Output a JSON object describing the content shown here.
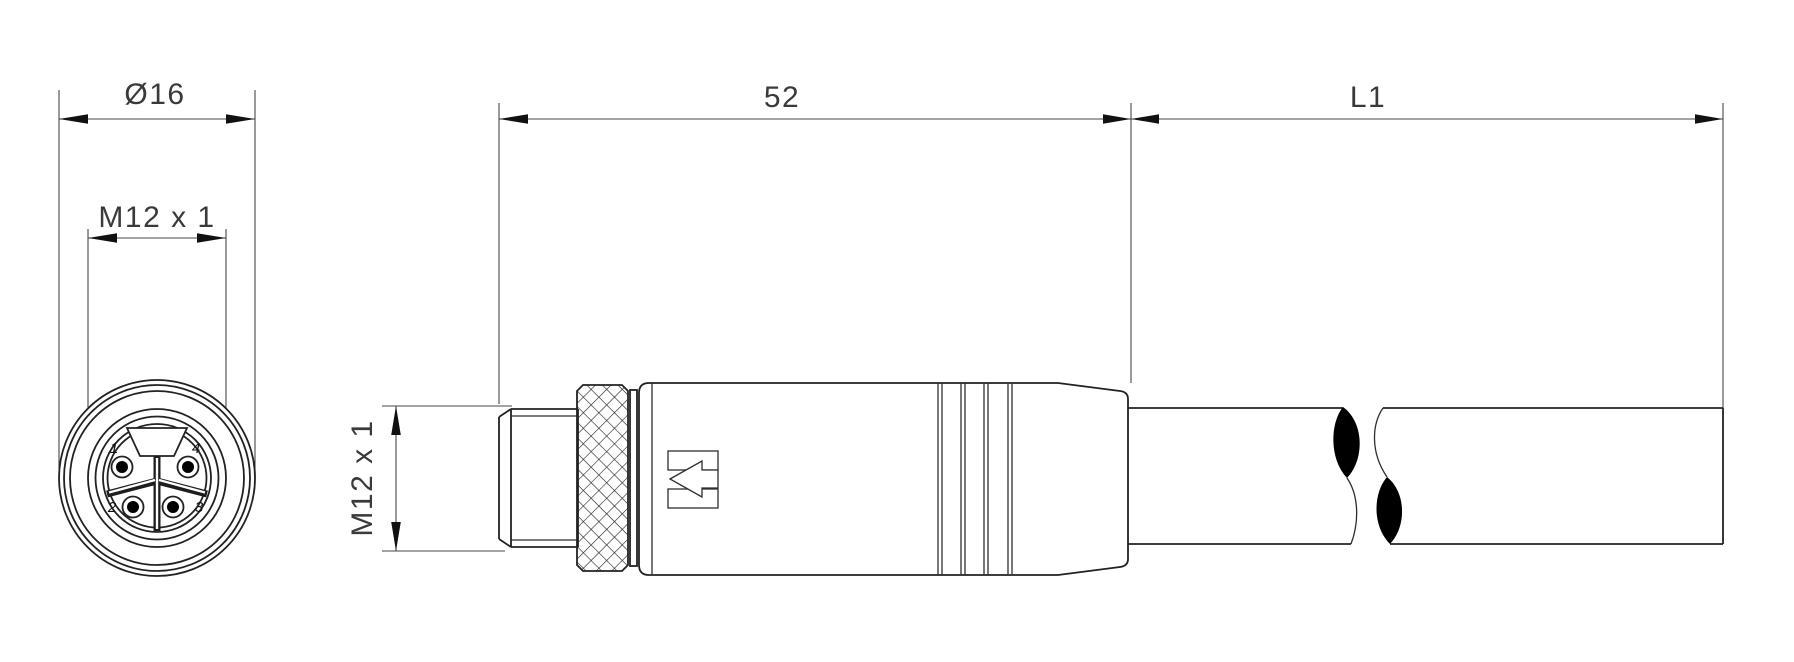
{
  "front_view": {
    "outer_diameter_label": "Ø16",
    "thread_label": "M12 x 1",
    "pin_labels": {
      "p1": "1",
      "p2": "2",
      "p3": "3",
      "p4": "4"
    }
  },
  "side_view": {
    "connector_length_label": "52",
    "cable_length_label": "L1",
    "thread_label": "M12 x 1"
  },
  "colors": {
    "object_line": "#222222",
    "dimension_line": "#474747",
    "text": "#3a3a3a",
    "background": "#ffffff",
    "cable_break_fill": "#000000"
  }
}
